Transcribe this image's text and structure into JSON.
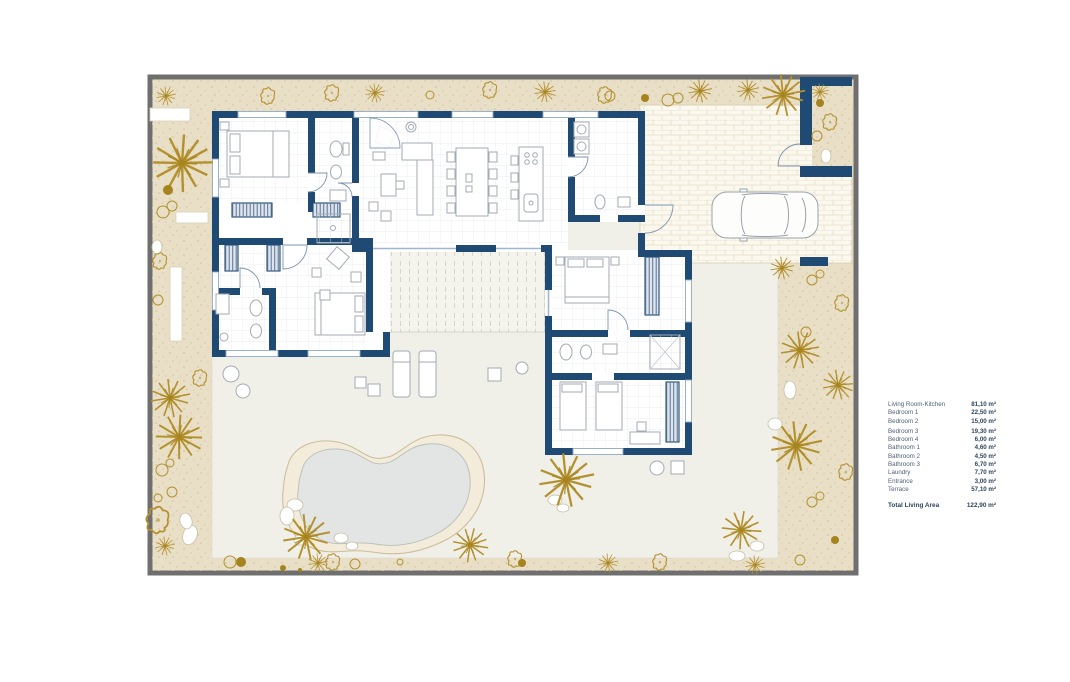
{
  "legend": {
    "rows": [
      {
        "label": "Living Room-Kitchen",
        "value": "81,10 m²"
      },
      {
        "label": "Bedroom 1",
        "value": "22,50 m²"
      },
      {
        "label": "Bedroom 2",
        "value": "15,00 m²"
      },
      {
        "label": "Bedroom 3",
        "value": "19,30 m²"
      },
      {
        "label": "Bedroom 4",
        "value": "6,00 m²"
      },
      {
        "label": "Bathroom 1",
        "value": "4,60 m²"
      },
      {
        "label": "Bathroom 2",
        "value": "4,50 m²"
      },
      {
        "label": "Bathroom 3",
        "value": "6,70 m²"
      },
      {
        "label": "Laundry",
        "value": "7,70 m²"
      },
      {
        "label": "Entrance",
        "value": "3,00 m²"
      },
      {
        "label": "Terrace",
        "value": "57,10 m²"
      }
    ],
    "total": {
      "label": "Total Living Area",
      "value": "122,90 m²"
    }
  },
  "colors": {
    "wall_navy": "#1e4a74",
    "garden_sand": "#e8dfc6",
    "plant_gold": "#b4912f",
    "pavement": "#f0efe8",
    "pool_water": "#e2e5e3",
    "frame_gray": "#6f6f6f"
  }
}
